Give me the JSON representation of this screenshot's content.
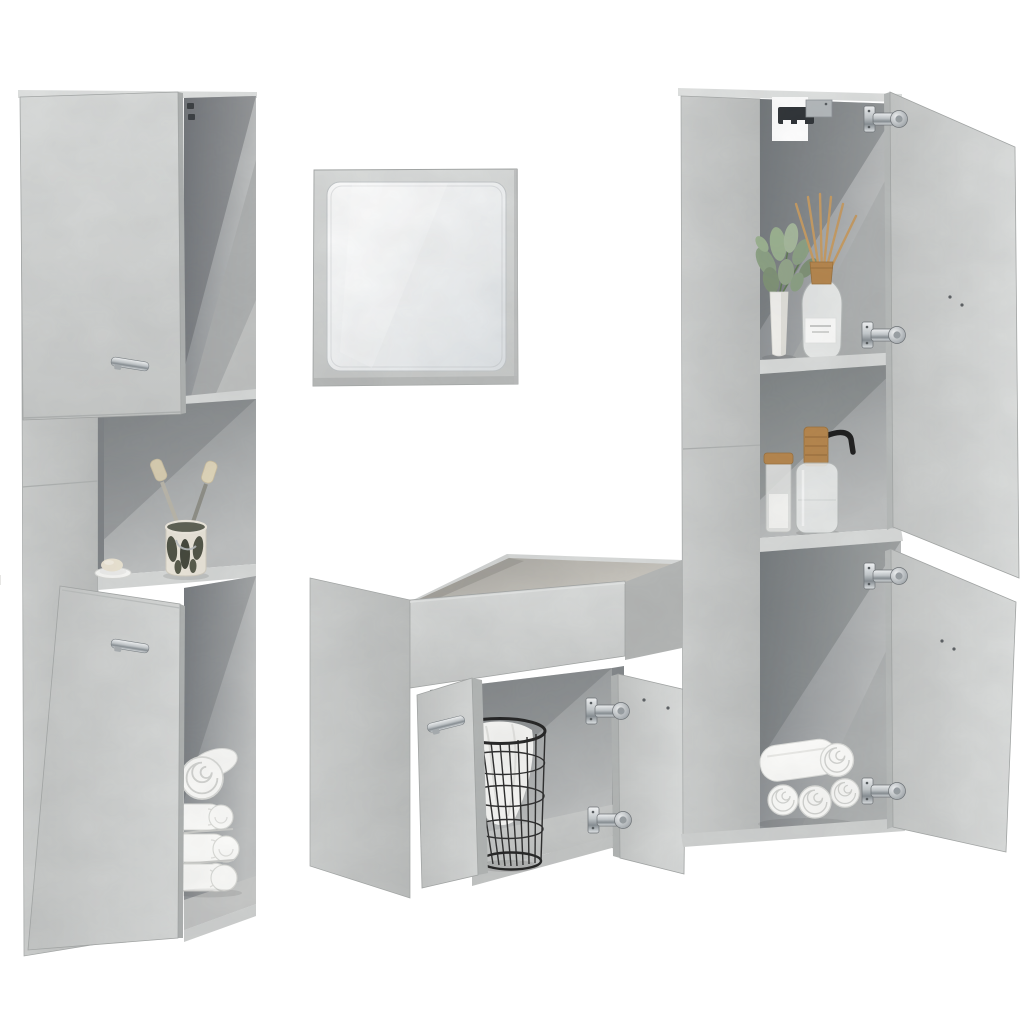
{
  "page": {
    "title": "Bathroom furniture set – concrete grey – product photo"
  },
  "image": {
    "type": "product-photo",
    "background_color": "#ffffff",
    "description": "4-piece bathroom furniture set in concrete grey: tall storage cabinet with ajar doors, square framed wall mirror, wash basin base cabinet with open doors and wire basket, and tall storage cabinet with wide-open doors, styled with towels, plant, diffuser and soap accessories",
    "finish": "concrete grey wood-effect panels"
  },
  "pieces": {
    "tall_cabinet_left": {
      "label": "Tall bathroom cabinet (left)",
      "features": [
        "upper door ajar with chrome bar handle",
        "lower door ajar with chrome bar handle",
        "open top side compartment",
        "open middle shelf"
      ],
      "contents": [
        "ceramic toothbrush cup with two toothbrushes",
        "soap dish with soap bar",
        "rolled white towel",
        "three folded white towels"
      ]
    },
    "wall_mirror": {
      "label": "Square wall mirror",
      "frame": "concrete grey frame",
      "glass": "rounded-corner mirror glass"
    },
    "basin_cabinet": {
      "label": "Wash basin base cabinet (centre)",
      "features": [
        "open-top basin recess",
        "left door ajar with chrome bar handle",
        "right door wide open on two chrome concealed hinges"
      ],
      "contents": [
        "black wire storage basket with white cloth"
      ]
    },
    "tall_cabinet_right": {
      "label": "Tall bathroom cabinet (right)",
      "features": [
        "upper door wide open on chrome hinges",
        "lower door wide open on chrome hinges",
        "open middle shelf",
        "white back-panel cut-out with black wall-mount bracket"
      ],
      "contents": [
        "potted green plant in white vase",
        "reed diffuser bottle with wooden cap",
        "storage jar with wooden lid",
        "soap dispenser with wooden pump and black spout",
        "rolled white towels"
      ]
    }
  },
  "hardware": {
    "handles": "chrome bar handles",
    "hinges": "chrome concealed cup hinges",
    "bracket": "black metal wall bracket"
  },
  "palette": {
    "background": "#ffffff",
    "panel_light": "#d7d9d8",
    "panel_mid": "#c7c9c8",
    "panel_side": "#bcbebd",
    "interior_dark": "#75797c",
    "interior_mid": "#a7aaab",
    "shelf_edge": "#d9dbda",
    "chrome": "#c9cdd0",
    "basket_black": "#2b2b2b",
    "towel_white": "#fbfbfa",
    "wood_tan": "#b5854c",
    "reed_tan": "#c49a62",
    "plant_green": "#8ba083",
    "soap_cream": "#eae3d2"
  }
}
